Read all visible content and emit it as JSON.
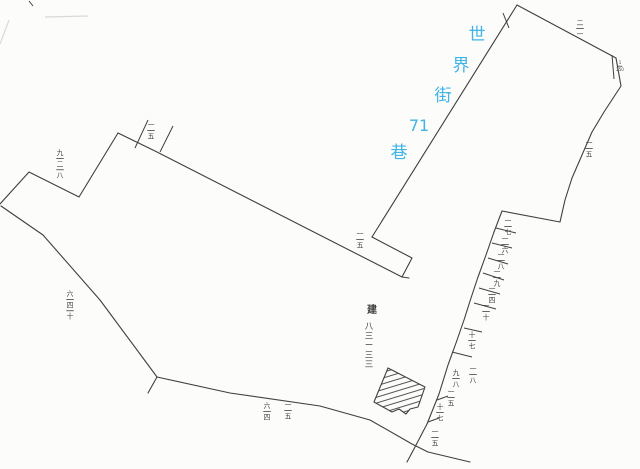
{
  "meta": {
    "description": "Hand-drawn cadastral parcel sketch map with street name annotation",
    "canvas": {
      "width": 640,
      "height": 469
    }
  },
  "colors": {
    "paper": "#fcfcfa",
    "ink": "#3f3f3f",
    "noise": "#d9d9d5",
    "road_text": "#41b4e7"
  },
  "road_label": {
    "text": "世界街71巷",
    "chars": [
      {
        "ch": "世",
        "x": 477,
        "y": 40,
        "fs": 17
      },
      {
        "ch": "界",
        "x": 461,
        "y": 71,
        "fs": 17
      },
      {
        "ch": "街",
        "x": 443,
        "y": 101,
        "fs": 17
      },
      {
        "ch": "71",
        "x": 419,
        "y": 131,
        "fs": 16
      },
      {
        "ch": "巷",
        "x": 399,
        "y": 158,
        "fs": 17
      }
    ]
  },
  "building_label": {
    "prefix": {
      "ch": "建",
      "x": 372,
      "y": 313,
      "fs": 10
    },
    "column": {
      "x": 369,
      "y_start": 329,
      "dy": 9.5,
      "fs": 8.5,
      "chars": [
        "八",
        "三",
        "ー",
        "三",
        "三"
      ]
    }
  },
  "boundaries": [
    {
      "name": "upper-left-zigzag",
      "points": [
        [
          0,
          204
        ],
        [
          29,
          172
        ],
        [
          79,
          197
        ],
        [
          118,
          133
        ]
      ]
    },
    {
      "name": "long-top-boundary",
      "points": [
        [
          118,
          133
        ],
        [
          155,
          151
        ],
        [
          402,
          277
        ]
      ]
    },
    {
      "name": "lower-left-boundary",
      "points": [
        [
          1,
          206
        ],
        [
          43,
          235
        ],
        [
          100,
          300
        ],
        [
          157,
          377
        ]
      ]
    },
    {
      "name": "bottom-left-spur",
      "points": [
        [
          157,
          377
        ],
        [
          148,
          393
        ]
      ]
    },
    {
      "name": "bottom-boundary",
      "points": [
        [
          157,
          377
        ],
        [
          230,
          393
        ],
        [
          320,
          406
        ],
        [
          370,
          420
        ],
        [
          412,
          444
        ],
        [
          428,
          452
        ],
        [
          470,
          462
        ]
      ]
    },
    {
      "name": "road-left-edge",
      "points": [
        [
          517,
          5
        ],
        [
          372,
          237
        ]
      ]
    },
    {
      "name": "road-bottom-notch",
      "points": [
        [
          372,
          237
        ],
        [
          412,
          258
        ],
        [
          402,
          277
        ],
        [
          409,
          278
        ]
      ]
    },
    {
      "name": "road-apex-right-edge",
      "points": [
        [
          517,
          5
        ],
        [
          616,
          58
        ]
      ]
    },
    {
      "name": "right-parcel-east-boundary",
      "points": [
        [
          616,
          58
        ],
        [
          621,
          86
        ],
        [
          604,
          112
        ],
        [
          592,
          132
        ],
        [
          582,
          155
        ],
        [
          572,
          178
        ],
        [
          565,
          200
        ],
        [
          560,
          222
        ]
      ]
    },
    {
      "name": "top-lot-division",
      "points": [
        [
          560,
          222
        ],
        [
          502,
          211
        ]
      ]
    },
    {
      "name": "right-parcel-west-boundary",
      "points": [
        [
          502,
          211
        ],
        [
          494,
          232
        ],
        [
          486,
          255
        ],
        [
          478,
          277
        ],
        [
          471,
          298
        ],
        [
          464,
          320
        ],
        [
          456,
          343
        ],
        [
          448,
          365
        ],
        [
          439,
          394
        ],
        [
          427,
          424
        ],
        [
          415,
          447
        ],
        [
          407,
          462
        ]
      ]
    }
  ],
  "lot_divisions": [
    [
      [
        496,
        228
      ],
      [
        516,
        233
      ]
    ],
    [
      [
        492,
        243
      ],
      [
        512,
        248
      ]
    ],
    [
      [
        488,
        258
      ],
      [
        508,
        264
      ]
    ],
    [
      [
        483,
        273
      ],
      [
        504,
        280
      ]
    ],
    [
      [
        479,
        288
      ],
      [
        500,
        294
      ]
    ],
    [
      [
        474,
        303
      ],
      [
        496,
        309
      ]
    ],
    [
      [
        464,
        328
      ],
      [
        482,
        332
      ]
    ],
    [
      [
        452,
        352
      ],
      [
        472,
        357
      ]
    ]
  ],
  "ticks": [
    {
      "name": "survey-tick",
      "p": [
        [
          135,
          148
        ],
        [
          148,
          120
        ]
      ]
    },
    {
      "name": "survey-tick",
      "p": [
        [
          160,
          152
        ],
        [
          173,
          126
        ]
      ]
    },
    {
      "name": "survey-tick",
      "p": [
        [
          503,
          13
        ],
        [
          509,
          28
        ]
      ]
    },
    {
      "name": "survey-tick",
      "p": [
        [
          612,
          55
        ],
        [
          614,
          79
        ]
      ]
    },
    {
      "name": "survey-tick",
      "p": [
        [
          437,
          400
        ],
        [
          448,
          396
        ]
      ]
    },
    {
      "name": "survey-tick",
      "p": [
        [
          428,
          422
        ],
        [
          439,
          418
        ]
      ]
    },
    {
      "name": "corner-mark",
      "p": [
        [
          29,
          1
        ],
        [
          33,
          6
        ]
      ]
    }
  ],
  "noise_marks": [
    {
      "p": [
        [
          45,
          17
        ],
        [
          88,
          16
        ]
      ]
    },
    {
      "p": [
        [
          0,
          44
        ],
        [
          9,
          20
        ]
      ]
    }
  ],
  "building": {
    "outline": [
      [
        388,
        368
      ],
      [
        425,
        387
      ],
      [
        418,
        407
      ],
      [
        410,
        409
      ],
      [
        406,
        414
      ],
      [
        399,
        409
      ],
      [
        392,
        412
      ],
      [
        374,
        402
      ]
    ],
    "hatch_angle_deg": -17,
    "hatch_spacing": 5.5
  },
  "lot_labels": [
    {
      "x": 151,
      "y": 120,
      "parts": [
        "一",
        "—",
        "五"
      ]
    },
    {
      "x": 60,
      "y": 148,
      "parts": [
        "九",
        "—",
        "二",
        "—",
        "八"
      ]
    },
    {
      "x": 70,
      "y": 289,
      "parts": [
        "六",
        "—",
        "四",
        "—",
        "十"
      ]
    },
    {
      "x": 267,
      "y": 401,
      "parts": [
        "六",
        "—",
        "四"
      ]
    },
    {
      "x": 288,
      "y": 400,
      "parts": [
        "一",
        "—",
        "五"
      ]
    },
    {
      "x": 360,
      "y": 229,
      "parts": [
        "一",
        "—",
        "五"
      ]
    },
    {
      "x": 580,
      "y": 18,
      "parts": [
        "二",
        "—",
        "一"
      ]
    },
    {
      "x": 589,
      "y": 138,
      "parts": [
        "一",
        "—",
        "五"
      ]
    },
    {
      "x": 620,
      "y": 60,
      "parts": [
        "1",
        "—",
        "250"
      ],
      "fs": 4
    },
    {
      "x": 508,
      "y": 216,
      "parts": [
        "一",
        "—",
        "七"
      ]
    },
    {
      "x": 505,
      "y": 234,
      "parts": [
        "一",
        "—",
        "六"
      ]
    },
    {
      "x": 501,
      "y": 250,
      "parts": [
        "一",
        "—",
        "八"
      ]
    },
    {
      "x": 497,
      "y": 267,
      "parts": [
        "一",
        "—",
        "九"
      ]
    },
    {
      "x": 492,
      "y": 284,
      "parts": [
        "一",
        "—",
        "四"
      ]
    },
    {
      "x": 486,
      "y": 301,
      "parts": [
        "一",
        "—",
        "十"
      ]
    },
    {
      "x": 472,
      "y": 330,
      "parts": [
        "十",
        "—",
        "七"
      ]
    },
    {
      "x": 473,
      "y": 364,
      "parts": [
        "一",
        "—",
        "八"
      ]
    },
    {
      "x": 456,
      "y": 368,
      "parts": [
        "九",
        "—",
        "八"
      ]
    },
    {
      "x": 451,
      "y": 387,
      "parts": [
        "一",
        "—",
        "五"
      ]
    },
    {
      "x": 440,
      "y": 402,
      "parts": [
        "十",
        "—",
        "七"
      ]
    },
    {
      "x": 435,
      "y": 427,
      "parts": [
        "一",
        "—",
        "五"
      ]
    }
  ]
}
